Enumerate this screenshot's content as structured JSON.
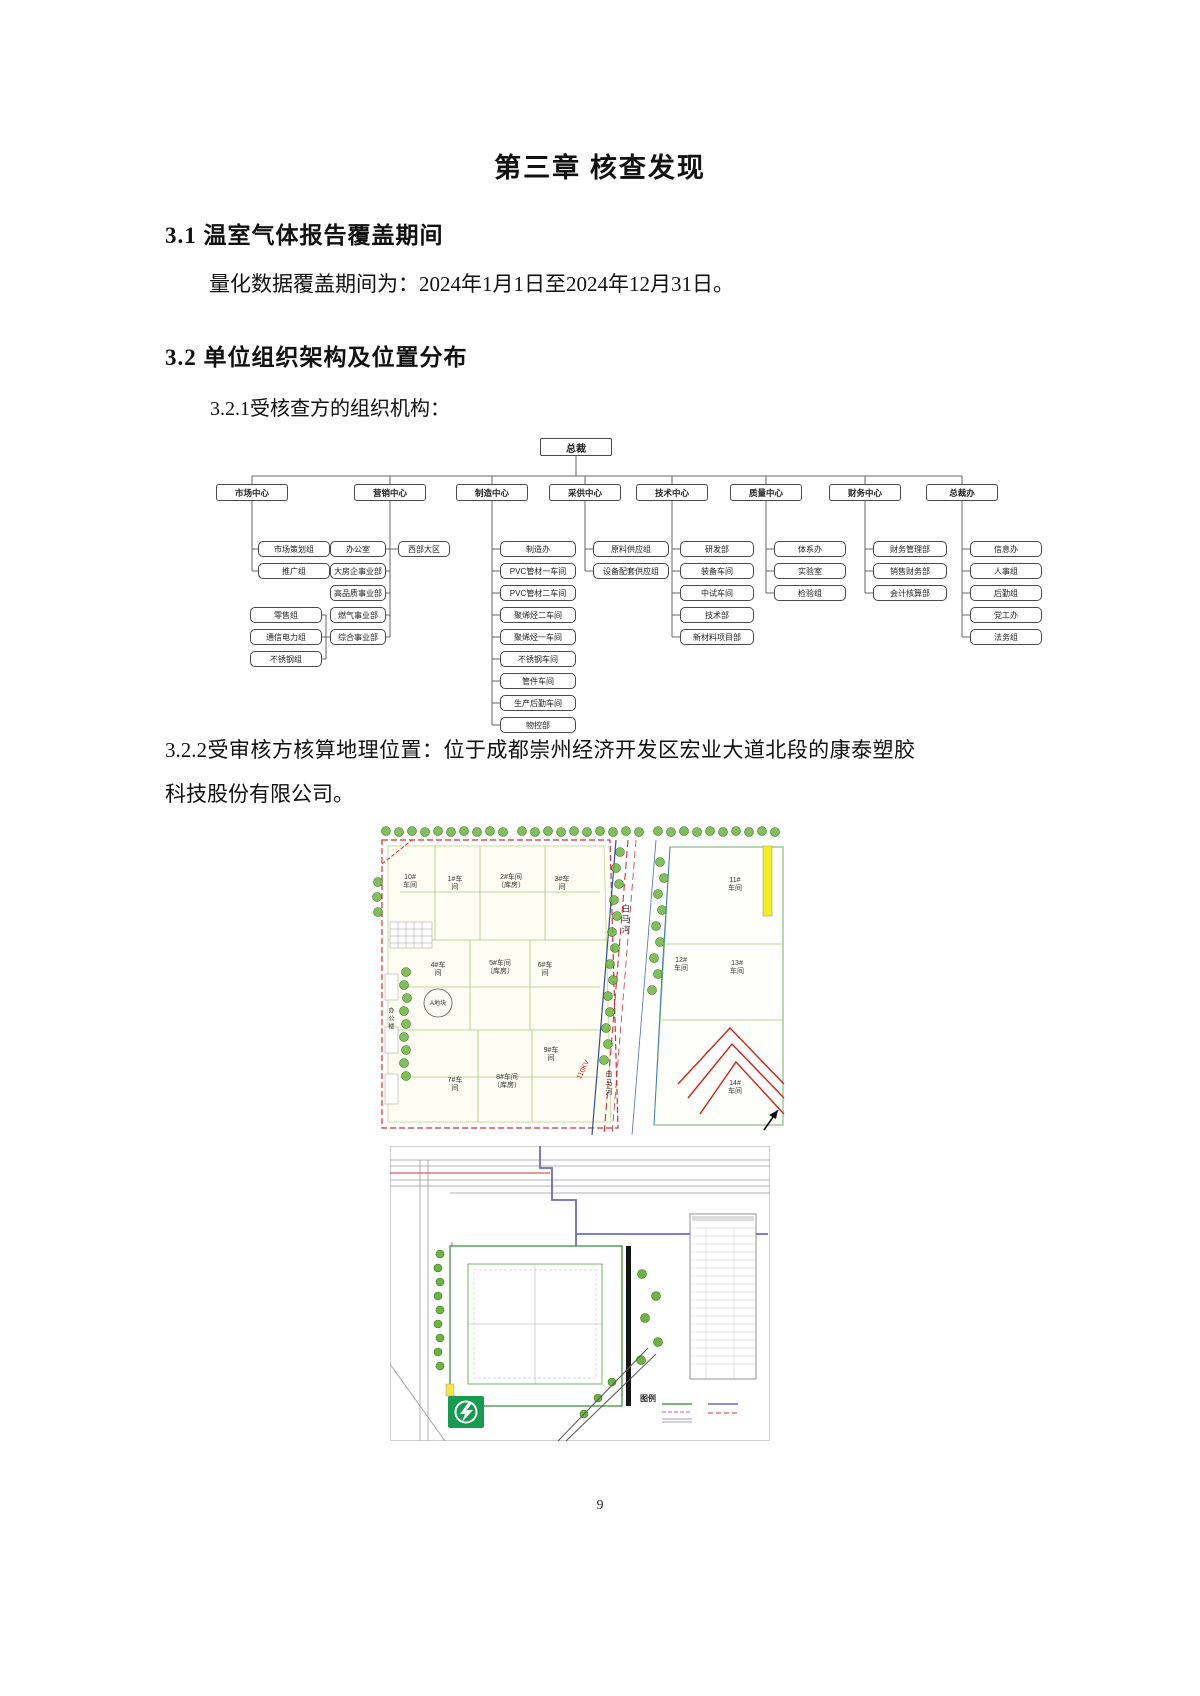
{
  "page": {
    "chapter_title": "第三章 核查发现",
    "page_number": "9"
  },
  "section_3_1": {
    "heading": "3.1 温室气体报告覆盖期间",
    "body": "量化数据覆盖期间为：2024年1月1日至2024年12月31日。"
  },
  "section_3_2": {
    "heading": "3.2 单位组织架构及位置分布",
    "item_3_2_1": "3.2.1受核查方的组织机构：",
    "item_3_2_2": "3.2.2受审核方核算地理位置：位于成都崇州经济开发区宏业大道北段的康泰塑胶科技股份有限公司。"
  },
  "org_chart": {
    "root": "总裁",
    "centers": [
      {
        "label": "市场中心",
        "children": [
          "市场策划组",
          "推广组"
        ],
        "subgroup": [
          "零售组",
          "通信电力组",
          "不锈钢组"
        ]
      },
      {
        "label": "营销中心",
        "children": [
          "办公室",
          "大房企事业部",
          "高品质事业部",
          "燃气事业部",
          "综合事业部"
        ],
        "side": "西部大区"
      },
      {
        "label": "制造中心",
        "children": [
          "制造办",
          "PVC管材一车间",
          "PVC管材二车间",
          "聚烯烃二车间",
          "聚烯烃一车间",
          "不锈钢车间",
          "管件车间",
          "生产后勤车间",
          "物控部"
        ]
      },
      {
        "label": "采供中心",
        "children": [
          "原料供应组",
          "设备配套供应组"
        ]
      },
      {
        "label": "技术中心",
        "children": [
          "研发部",
          "装备车间",
          "中试车间",
          "技术部",
          "新材料项目部"
        ]
      },
      {
        "label": "质量中心",
        "children": [
          "体系办",
          "实验室",
          "检验组"
        ]
      },
      {
        "label": "财务中心",
        "children": [
          "财务管理部",
          "销售财务部",
          "会计核算部"
        ]
      },
      {
        "label": "总裁办",
        "children": [
          "信息办",
          "人事组",
          "后勤组",
          "党工办",
          "法务组"
        ]
      }
    ]
  },
  "site_map_1": {
    "labels": {
      "b10": "10#\n车间",
      "b1": "1#车\n间",
      "b2": "2#车间\n（库房）",
      "b3": "3#车\n间",
      "b11": "11#\n车间",
      "b4": "4#车\n间",
      "b5": "5#车间\n（库房）",
      "b6": "6#车\n间",
      "b12": "12#\n车间",
      "b13": "13#\n车间",
      "b9": "9#车\n间",
      "b7": "7#车\n间",
      "b8": "8#车间\n（库房）",
      "b14": "14#\n车间",
      "river1": "白马河",
      "river2": "白马河",
      "plot": "A地块",
      "office": "办公楼",
      "kv": "110KV"
    }
  },
  "site_map_2": {
    "legend_title": "图例"
  }
}
